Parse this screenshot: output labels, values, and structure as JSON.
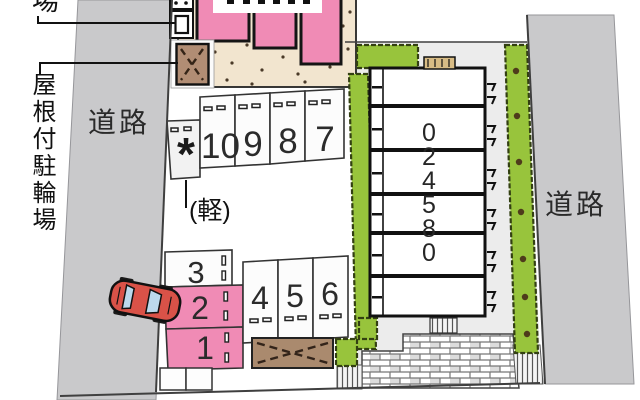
{
  "plan": {
    "roads": {
      "left": "道路",
      "right": "道路"
    },
    "labels": {
      "covered_bike_parking": "屋根付駐輪場",
      "cropped_place_label": "場",
      "kei_note": "(軽)",
      "kei_mark": "*"
    },
    "parking": {
      "top_row": [
        "10",
        "9",
        "8",
        "7"
      ],
      "left_column": [
        "3",
        "2",
        "1"
      ],
      "middle_row": [
        "4",
        "5",
        "6"
      ]
    },
    "building": {
      "number_vertical": "024580",
      "digits": [
        "0",
        "2",
        "4",
        "5",
        "8",
        "0"
      ]
    },
    "colors": {
      "road_gray": "#c9c9cb",
      "pink": "#f08bb5",
      "walkway_tan": "#f2e5cf",
      "shed_brown": "#b18d74",
      "hedge_green": "#98c43c",
      "car_red": "#d95248",
      "lot_gray": "#ececec"
    }
  }
}
